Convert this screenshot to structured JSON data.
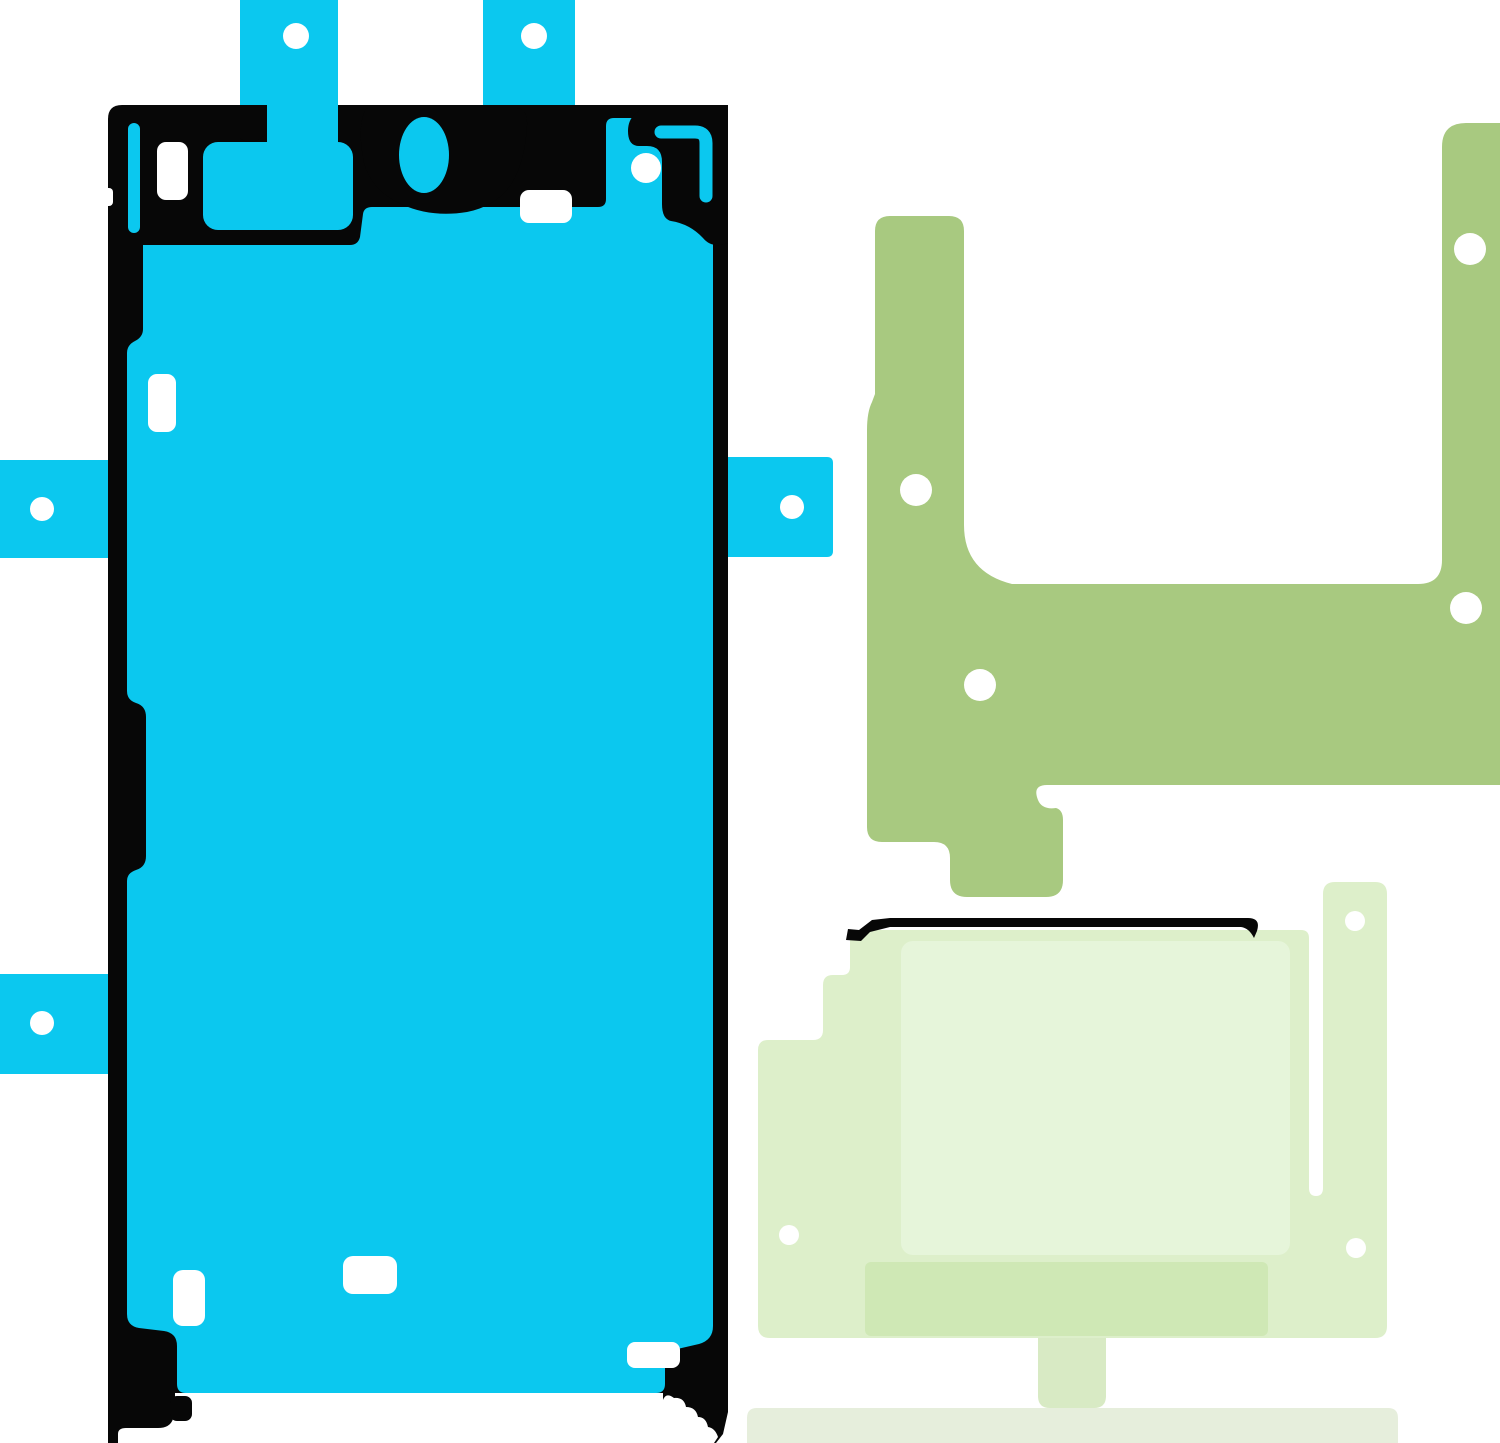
{
  "scene": {
    "description": "Product image: smartphone repair adhesive sticker set (three die-cut adhesive sheets on white background)",
    "width": 1500,
    "height": 1443,
    "background": "#ffffff"
  },
  "colors": {
    "cyan": "#0bc8ef",
    "black": "#070707",
    "white": "#ffffff",
    "olive": "#a8c980",
    "lightgreen_body": "#ddefca",
    "lightgreen_inner": "#e6f5da",
    "lightgreen_dark": "#cfe8b5",
    "lightgreen_tab": "#d8eac4",
    "strip": "#e6eedc"
  },
  "artwork": {
    "viewbox": "0 0 1500 1443",
    "shapes": [
      {
        "name": "screen-tab-top-left-cyan",
        "type": "rect",
        "x": 240,
        "y": 0,
        "w": 98,
        "h": 108,
        "rx": 0,
        "fill": "#0bc8ef"
      },
      {
        "name": "screen-tab-top-right-cyan",
        "type": "rect",
        "x": 483,
        "y": 0,
        "w": 92,
        "h": 108,
        "rx": 0,
        "fill": "#0bc8ef"
      },
      {
        "name": "screen-tab-hole-top-left",
        "type": "circle",
        "cx": 296,
        "cy": 36,
        "r": 13,
        "fill": "#ffffff"
      },
      {
        "name": "screen-tab-hole-top-right",
        "type": "circle",
        "cx": 534,
        "cy": 36,
        "r": 13,
        "fill": "#ffffff"
      },
      {
        "name": "screen-tab-left-upper-cyan",
        "type": "rect",
        "x": 0,
        "y": 460,
        "w": 112,
        "h": 98,
        "rx": 0,
        "fill": "#0bc8ef"
      },
      {
        "name": "screen-tab-hole-left-upper",
        "type": "circle",
        "cx": 42,
        "cy": 509,
        "r": 12,
        "fill": "#ffffff"
      },
      {
        "name": "screen-tab-left-lower-cyan",
        "type": "rect",
        "x": 0,
        "y": 974,
        "w": 112,
        "h": 100,
        "rx": 0,
        "fill": "#0bc8ef"
      },
      {
        "name": "screen-tab-hole-left-lower",
        "type": "circle",
        "cx": 42,
        "cy": 1023,
        "r": 12,
        "fill": "#ffffff"
      },
      {
        "name": "screen-tab-right-cyan",
        "type": "path",
        "d": "M713,457 H827 Q833,457 833,463 V551 Q833,557 827,557 H713 Z",
        "fill": "#0bc8ef"
      },
      {
        "name": "screen-tab-hole-right",
        "type": "circle",
        "cx": 792,
        "cy": 507,
        "r": 12,
        "fill": "#ffffff"
      },
      {
        "name": "screen-adhesive-black-base",
        "type": "path",
        "d": "M122,105 H714 Q728,105 728,119 V1443 H108 V119 Q108,105 122,105 Z",
        "fill": "#070707"
      },
      {
        "name": "screen-bottom-white-area",
        "type": "rect",
        "x": 175,
        "y": 1393,
        "w": 488,
        "h": 50,
        "rx": 0,
        "fill": "#ffffff"
      },
      {
        "name": "screen-bottom-left-foot-cut",
        "type": "path",
        "d": "M118,1443 V1434 Q118,1428 126,1428 H158 Q170,1428 173,1419 L175,1410 L175,1443 Z",
        "fill": "#ffffff"
      },
      {
        "name": "screen-bottom-right-wiggle-cut",
        "type": "path",
        "d": "M663,1443 V1400 Q666,1392 674,1398 Q684,1397 686,1407 Q696,1407 698,1417 Q706,1417 708,1427 Q715,1428 718,1437 L714,1443 Z",
        "fill": "#ffffff"
      },
      {
        "name": "screen-bottom-right-tip-cut",
        "type": "path",
        "d": "M716,1443 L723,1434 L728,1412 V1443 Z",
        "fill": "#ffffff"
      },
      {
        "name": "screen-left-edge-notch",
        "type": "rect",
        "x": 103,
        "y": 188,
        "w": 10,
        "h": 18,
        "rx": 4,
        "fill": "#ffffff"
      },
      {
        "name": "screen-right-edge-notch",
        "type": "rect",
        "x": 722,
        "y": 195,
        "w": 10,
        "h": 20,
        "rx": 4,
        "fill": "#ffffff"
      },
      {
        "name": "screen-interior-cyan",
        "type": "path",
        "d": "M143,245 H350 Q358,245 360,237 L363,214 Q364,207 372,207 H598 Q606,207 606,199 V126 Q606,118 614,118 H713 V1326 Q713,1340 699,1344 L673,1350 Q665,1352 665,1361 V1384 Q665,1393 656,1393 H186 Q177,1393 177,1384 V1346 Q177,1333 164,1331 L139,1328 Q127,1326 127,1314 V881 Q127,873 136,870 Q146,867 146,856 V717 Q146,706 136,703 Q127,700 127,691 V353 Q127,345 135,341 Q143,337 143,329 Z",
        "fill": "#0bc8ef"
      },
      {
        "name": "screen-tab-channel-cyan",
        "type": "rect",
        "x": 267,
        "y": 103,
        "w": 71,
        "h": 57,
        "rx": 0,
        "fill": "#0bc8ef"
      },
      {
        "name": "screen-peninsula-cyan",
        "type": "rect",
        "x": 203,
        "y": 142,
        "w": 150,
        "h": 88,
        "rx": 15,
        "fill": "#0bc8ef"
      },
      {
        "name": "screen-under-tab-black-notch",
        "type": "path",
        "d": "M240,105 H267 V133 Q252,148 240,138 Z",
        "fill": "#070707"
      },
      {
        "name": "screen-slot-cutout-cyan",
        "type": "rect",
        "x": 128,
        "y": 123,
        "w": 12,
        "h": 110,
        "rx": 6,
        "fill": "#0bc8ef"
      },
      {
        "name": "screen-hole-top-left",
        "type": "rect",
        "x": 157,
        "y": 142,
        "w": 31,
        "h": 58,
        "rx": 9,
        "fill": "#ffffff"
      },
      {
        "name": "camera-ring-black",
        "type": "path",
        "d": "M368,108 H516 Q528,108 527,126 Q525,161 512,183 Q497,206 467,212 Q431,218 401,204 Q372,191 364,163 Q358,133 363,116 Q365,108 368,108 Z",
        "fill": "#070707"
      },
      {
        "name": "camera-cutout-cyan",
        "type": "ellipse",
        "cx": 424,
        "cy": 155,
        "rx": 25,
        "ry": 38,
        "fill": "#0bc8ef"
      },
      {
        "name": "screen-hole-mid-top",
        "type": "rect",
        "x": 520,
        "y": 190,
        "w": 52,
        "h": 33,
        "rx": 9,
        "fill": "#ffffff"
      },
      {
        "name": "screen-corner-top-right-black",
        "type": "path",
        "d": "M648,105 H728 V243 Q712,249 703,238 Q690,224 671,221 Q662,219 662,204 V162 Q662,146 647,146 H639 Q628,146 628,131 Q628,118 638,112 Q642,105 648,105 Z",
        "fill": "#070707"
      },
      {
        "name": "screen-corner-bracket-cyan",
        "type": "path",
        "d": "M661,132 H695 Q706,132 706,143 V196",
        "fill": "none",
        "stroke": "#0bc8ef",
        "strokeWidth": 13,
        "linecap": "round"
      },
      {
        "name": "screen-hole-circle-top-right",
        "type": "circle",
        "cx": 646,
        "cy": 168,
        "r": 15,
        "fill": "#ffffff"
      },
      {
        "name": "screen-hole-left-mid",
        "type": "rect",
        "x": 148,
        "y": 374,
        "w": 28,
        "h": 58,
        "rx": 9,
        "fill": "#ffffff"
      },
      {
        "name": "screen-hole-bottom-left",
        "type": "rect",
        "x": 173,
        "y": 1270,
        "w": 32,
        "h": 56,
        "rx": 10,
        "fill": "#ffffff"
      },
      {
        "name": "screen-hole-bottom-mid",
        "type": "rect",
        "x": 343,
        "y": 1256,
        "w": 54,
        "h": 38,
        "rx": 10,
        "fill": "#ffffff"
      },
      {
        "name": "screen-hole-bottom-right",
        "type": "rect",
        "x": 627,
        "y": 1342,
        "w": 53,
        "h": 26,
        "rx": 8,
        "fill": "#ffffff"
      },
      {
        "name": "screen-bottom-left-knob-black",
        "type": "rect",
        "x": 170,
        "y": 1396,
        "w": 22,
        "h": 25,
        "rx": 7,
        "fill": "#070707"
      },
      {
        "name": "frame-adhesive-olive",
        "type": "path",
        "d": "M875,231 Q875,216 890,216 H949 Q964,216 964,231 V525 Q964,572 1012,584 H1418 Q1442,584 1442,560 V147 Q1442,123 1466,123 H1500 V785 H1047 Q1032,785 1038,800 Q1042,810 1056,808 Q1063,810 1063,820 V880 Q1063,897 1046,897 H967 Q950,897 950,880 V858 Q950,842 934,842 H882 Q867,842 867,827 V430 Q867,412 872,402 L875,394 Z",
        "fill": "#a8c980"
      },
      {
        "name": "frame-hole-left-arm",
        "type": "circle",
        "cx": 916,
        "cy": 490,
        "r": 16,
        "fill": "#ffffff"
      },
      {
        "name": "frame-hole-right-arm",
        "type": "circle",
        "cx": 1470,
        "cy": 249,
        "r": 16,
        "fill": "#ffffff"
      },
      {
        "name": "frame-hole-right-lower",
        "type": "circle",
        "cx": 1466,
        "cy": 608,
        "r": 16,
        "fill": "#ffffff"
      },
      {
        "name": "frame-hole-bottom",
        "type": "circle",
        "cx": 980,
        "cy": 685,
        "r": 16,
        "fill": "#ffffff"
      },
      {
        "name": "display-adhesive-body",
        "type": "path",
        "d": "M852,930 H1301 Q1309,930 1309,938 V1188 Q1309,1196 1316,1196 Q1323,1196 1323,1188 V894 Q1323,882 1335,882 H1375 Q1387,882 1387,894 V1326 Q1387,1338 1375,1338 H770 Q758,1338 758,1326 V1050 Q758,1040 768,1040 H813 Q823,1040 823,1030 V985 Q823,975 833,975 H842 Q850,975 850,967 V936 Q850,930 852,930 Z",
        "fill": "#ddefca"
      },
      {
        "name": "display-adhesive-inner-sheet",
        "type": "rect",
        "x": 901,
        "y": 941,
        "w": 389,
        "h": 314,
        "rx": 12,
        "fill": "#e6f5da"
      },
      {
        "name": "display-adhesive-dark-band",
        "type": "rect",
        "x": 865,
        "y": 1262,
        "w": 403,
        "h": 74,
        "rx": 6,
        "fill": "#cfe8b5"
      },
      {
        "name": "display-hole-column-top",
        "type": "circle",
        "cx": 1355,
        "cy": 921,
        "r": 10,
        "fill": "#ffffff"
      },
      {
        "name": "display-hole-column-bottom",
        "type": "circle",
        "cx": 1356,
        "cy": 1248,
        "r": 10,
        "fill": "#ffffff"
      },
      {
        "name": "display-hole-left",
        "type": "circle",
        "cx": 789,
        "cy": 1235,
        "r": 10,
        "fill": "#ffffff"
      },
      {
        "name": "display-top-black-line",
        "type": "path",
        "d": "M890,918 H1248 Q1261,918 1257,931 L1254,938 Q1249,928 1241,927 H890 Z",
        "fill": "#070707"
      },
      {
        "name": "display-black-line-zigzag-end",
        "type": "path",
        "d": "M890,918 L872,920 L859,930 L848,929 L846,940 L861,941 L870,932 L890,927 Z",
        "fill": "#070707"
      },
      {
        "name": "display-bottom-pull-tab",
        "type": "path",
        "d": "M1038,1338 H1106 V1396 Q1106,1408 1094,1408 H1050 Q1038,1408 1038,1396 Z",
        "fill": "#d8eac4"
      },
      {
        "name": "bottom-adhesive-strip",
        "type": "path",
        "d": "M757,1408 H1388 Q1398,1408 1398,1418 V1443 H747 V1418 Q747,1408 757,1408 Z",
        "fill": "#e6eedc"
      }
    ]
  }
}
